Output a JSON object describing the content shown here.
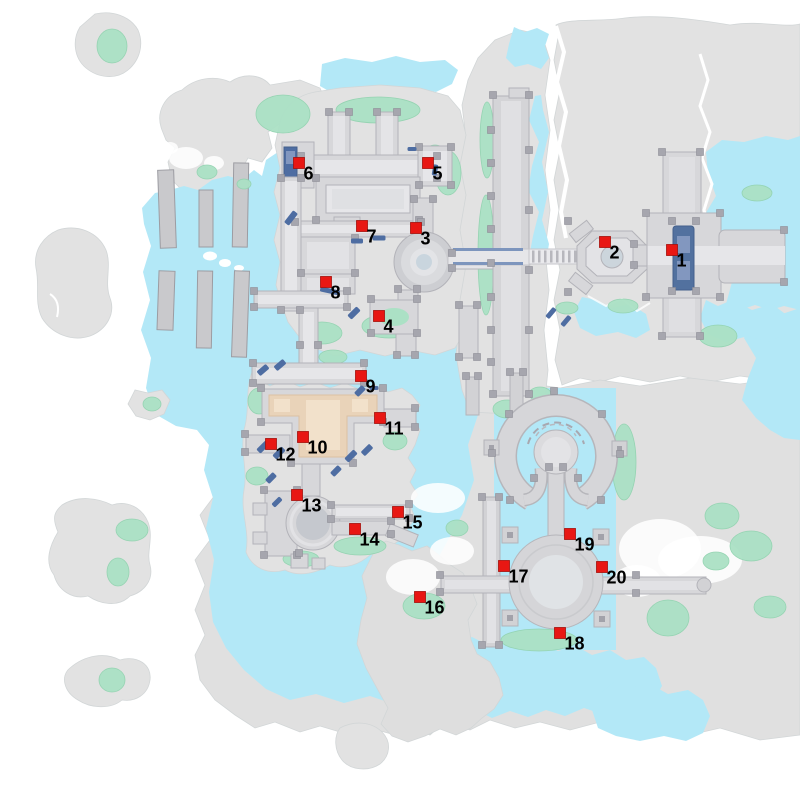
{
  "map": {
    "colors": {
      "background": "#ffffff",
      "water": "#b3e8f7",
      "land": "#e2e2e2",
      "land_edge": "#d2d6d7",
      "vegetation": "#abe1c5",
      "vegetation_edge": "#92d3b0",
      "structure": "#d7d7da",
      "structure_edge": "#b3b3b9",
      "structure_node": "#a6a6ae",
      "walkway": "#e6e6e9",
      "pool_blue": "#52719f",
      "pool_blue_light": "#8297bf",
      "accent_blue": "#4e6da2",
      "floor_orange": "#e9d3b9",
      "floor_orange_light": "#f2e1cb",
      "fog": "#ffffff",
      "marker": "#e81713",
      "marker_edge": "#a50f0b",
      "marker_label": "#000000"
    },
    "markers": [
      {
        "label": "1",
        "x": 672,
        "y": 250
      },
      {
        "label": "2",
        "x": 605,
        "y": 242
      },
      {
        "label": "3",
        "x": 416,
        "y": 228
      },
      {
        "label": "4",
        "x": 379,
        "y": 316
      },
      {
        "label": "5",
        "x": 428,
        "y": 163
      },
      {
        "label": "6",
        "x": 299,
        "y": 163
      },
      {
        "label": "7",
        "x": 362,
        "y": 226
      },
      {
        "label": "8",
        "x": 326,
        "y": 282
      },
      {
        "label": "9",
        "x": 361,
        "y": 376
      },
      {
        "label": "10",
        "x": 303,
        "y": 437
      },
      {
        "label": "11",
        "x": 380,
        "y": 418
      },
      {
        "label": "12",
        "x": 271,
        "y": 444
      },
      {
        "label": "13",
        "x": 297,
        "y": 495
      },
      {
        "label": "14",
        "x": 355,
        "y": 529
      },
      {
        "label": "15",
        "x": 398,
        "y": 512
      },
      {
        "label": "16",
        "x": 420,
        "y": 597
      },
      {
        "label": "17",
        "x": 504,
        "y": 566
      },
      {
        "label": "18",
        "x": 560,
        "y": 633
      },
      {
        "label": "19",
        "x": 570,
        "y": 534
      },
      {
        "label": "20",
        "x": 602,
        "y": 567
      }
    ]
  }
}
